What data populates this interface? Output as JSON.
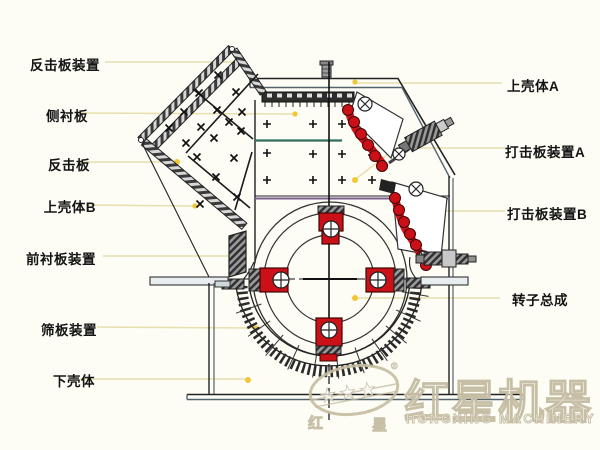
{
  "page": {
    "width": 600,
    "height": 450,
    "kind": "impact-crusher-structure-diagram"
  },
  "labels": {
    "left": [
      {
        "text": "反击板装置"
      },
      {
        "text": "侧衬板"
      },
      {
        "text": "反击板"
      },
      {
        "text": "上壳体B"
      },
      {
        "text": "前衬板装置"
      },
      {
        "text": "筛板装置"
      },
      {
        "text": "下壳体"
      }
    ],
    "right": [
      {
        "text": "上壳体A"
      },
      {
        "text": "打击板装置A"
      },
      {
        "text": "打击板装置B"
      },
      {
        "text": "转子总成"
      }
    ]
  },
  "watermark": {
    "brand_cn": "红星机器",
    "brand_en": "HONGXING MACHINERY",
    "stamp_left": "红",
    "stamp_right": "星",
    "registered": "®",
    "stars": "★★★"
  },
  "colors": {
    "background": "#fdfcf5",
    "line": "#222222",
    "accent_red": "#cb1117",
    "panel_teal": "#2f6e5e",
    "panel_purple": "#7a5e8e",
    "leader_line": "#e7dfae",
    "marker_dot": "#f2c636",
    "steel_blue": "#53646e",
    "watermark": "#cec7b2"
  }
}
